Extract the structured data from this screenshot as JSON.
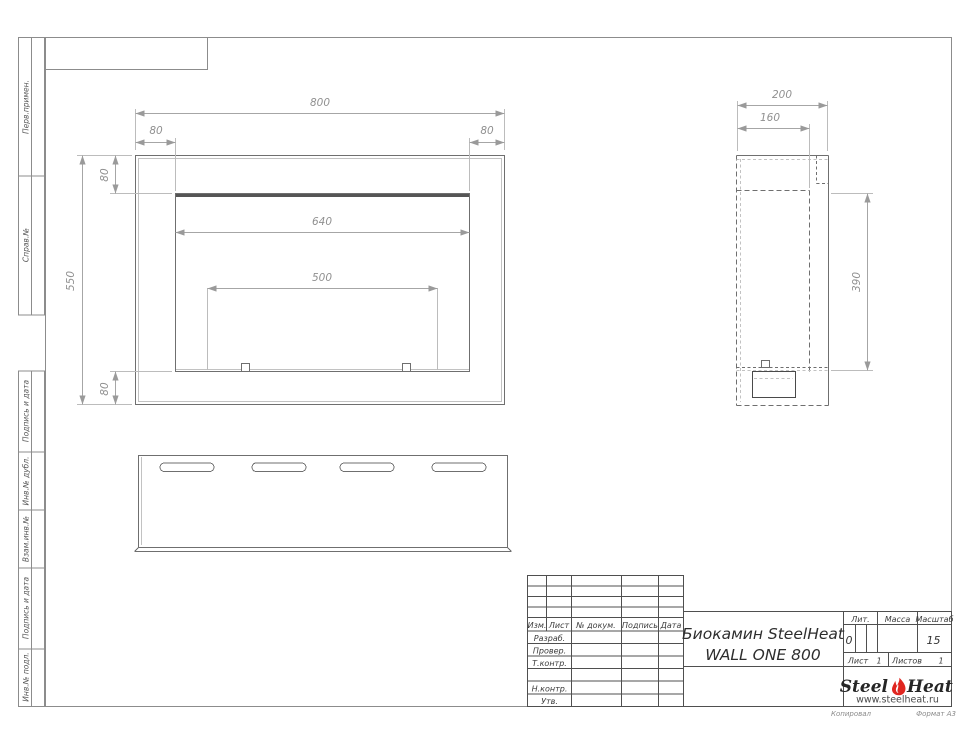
{
  "colors": {
    "flame": "#e02620",
    "line": "#6f6f6f",
    "dim": "#9a9a9a"
  },
  "margin": {
    "labels": [
      "Перв.примен.",
      "Справ.№",
      "Подпись и дата",
      "Инв.№ дубл.",
      "Взам.инв.№",
      "Подпись и дата",
      "Инв.№ подл."
    ]
  },
  "dims": {
    "front": {
      "total_width": "800",
      "flange_left": "80",
      "flange_right": "80",
      "flange_top": "80",
      "total_height": "550",
      "flange_bottom": "80",
      "opening_width": "640",
      "burner_width": "500"
    },
    "side": {
      "depth": "200",
      "inner_depth": "160",
      "opening_height": "390"
    }
  },
  "title_block": {
    "rev_header": [
      "Изм.",
      "Лист",
      "№ докум.",
      "Подпись",
      "Дата"
    ],
    "rows": [
      "Разраб.",
      "Провер.",
      "Т.контр.",
      "Н.контр.",
      "Утв."
    ],
    "title_line1": "Биокамин SteelHeat",
    "title_line2": "WALL ONE 800",
    "lit_label": "Лит.",
    "lit_value": "0",
    "mass_label": "Масса",
    "scale_label": "Масштаб",
    "scale_value": "15",
    "sheet_label": "Лист",
    "sheet_number": "1",
    "sheets_label": "Листов",
    "sheets_total": "1",
    "logo": {
      "steel": "Steel",
      "heat": "Heat",
      "url": "www.steelheat.ru"
    },
    "footer_left": "Копировал",
    "footer_right": "Формат А3"
  }
}
